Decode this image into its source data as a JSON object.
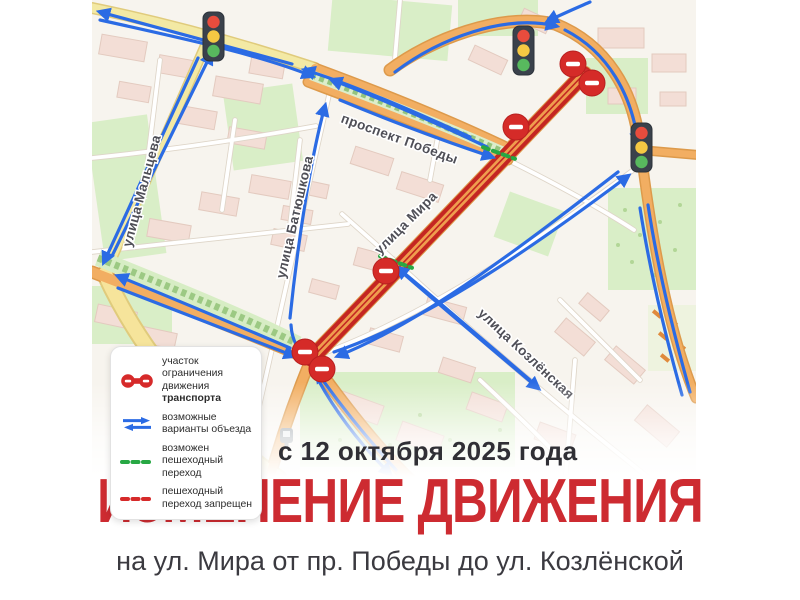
{
  "poster": {
    "date_banner": "с 12 октября 2025 года",
    "title": "ИЗМЕНЕНИЕ ДВИЖЕНИЯ",
    "subtitle": "на ул. Мира от пр. Победы до ул. Козлёнской",
    "title_color": "#cd2b31"
  },
  "legend": {
    "items": [
      {
        "icon": "restricted-segment-icon",
        "line1": "участок ограничения",
        "line2": "движения ",
        "line2_bold": "транспорта"
      },
      {
        "icon": "detour-arrows-icon",
        "line1": "возможные",
        "line2": "варианты объезда",
        "line2_bold": ""
      },
      {
        "icon": "crossing-allowed-icon",
        "line1": "возможен",
        "line2": "пешеходный переход",
        "line2_bold": ""
      },
      {
        "icon": "crossing-forbidden-icon",
        "line1": "пешеходный",
        "line2": "переход запрещен",
        "line2_bold": ""
      }
    ]
  },
  "map": {
    "street_labels": [
      {
        "text": "улица Мальцева",
        "x": 146,
        "y": 192,
        "rot": -75
      },
      {
        "text": "улица Батюшкова",
        "x": 299,
        "y": 218,
        "rot": -77
      },
      {
        "text": "проспект Победы",
        "x": 398,
        "y": 143,
        "rot": 20
      },
      {
        "text": "улица Мира",
        "x": 409,
        "y": 226,
        "rot": -45
      },
      {
        "text": "улица Козлёнская",
        "x": 523,
        "y": 357,
        "rot": 43
      }
    ],
    "traffic_lights": [
      {
        "x": 203,
        "y": 12
      },
      {
        "x": 513,
        "y": 26
      },
      {
        "x": 631,
        "y": 123
      }
    ],
    "no_entry_signs": [
      {
        "x": 573,
        "y": 64
      },
      {
        "x": 592,
        "y": 83
      },
      {
        "x": 516,
        "y": 127
      },
      {
        "x": 386,
        "y": 271
      },
      {
        "x": 305,
        "y": 352
      },
      {
        "x": 322,
        "y": 369
      }
    ],
    "crossings": [
      {
        "type": "allowed",
        "x": 499,
        "y": 153,
        "rot": 20,
        "len": 34
      },
      {
        "type": "allowed",
        "x": 396,
        "y": 262,
        "rot": 20,
        "len": 34
      },
      {
        "type": "forbidden",
        "x": 584,
        "y": 70,
        "rot": 22,
        "len": 40
      }
    ],
    "restricted_segment": {
      "d": "M 584 74 L 311 359"
    },
    "detour_arrows": [
      {
        "d": "M 470 137 C 400 105 345 82 305 70",
        "head": true
      },
      {
        "d": "M 292 64 C 210 42 150 26 100 12",
        "head": true
      },
      {
        "d": "M 100 20 C 200 42 262 56 312 76",
        "head": true
      },
      {
        "d": "M 395 72 C 440 38 505 14 556 26",
        "head": true
      },
      {
        "d": "M 565 30 C 608 52 632 95 638 143",
        "head": true
      },
      {
        "d": "M 590 2 C 574 9 560 15 548 21",
        "head": true
      },
      {
        "d": "M 198 58 L 104 262",
        "head": true
      },
      {
        "d": "M 112 256 L 211 54",
        "head": true
      },
      {
        "d": "M 290 318 C 297 250 310 160 325 106",
        "head": true
      },
      {
        "d": "M 291 325 C 292 342 299 351 307 357",
        "head": true
      },
      {
        "d": "M 340 100 C 400 125 450 143 492 157",
        "head": true
      },
      {
        "d": "M 487 147 C 432 121 382 99 332 80",
        "head": true
      },
      {
        "d": "M 396 470 C 365 436 338 402 317 372",
        "head": true
      },
      {
        "d": "M 312 368 C 330 404 356 440 390 474",
        "head": true
      },
      {
        "d": "M 334 352 C 430 320 540 242 628 176",
        "head": true
      },
      {
        "d": "M 618 172 C 530 240 424 322 338 356",
        "head": true
      },
      {
        "d": "M 404 274 C 455 318 500 356 538 388",
        "head": true
      },
      {
        "d": "M 530 380 C 490 346 444 306 398 268",
        "head": true
      },
      {
        "d": "M 118 288 C 190 316 252 340 294 356",
        "head": true
      },
      {
        "d": "M 290 348 C 220 318 162 294 118 276",
        "head": true
      },
      {
        "d": "M 648 205 C 658 270 674 335 690 392",
        "head": false
      },
      {
        "d": "M 640 208 C 650 272 666 338 682 395",
        "head": false
      }
    ],
    "icons": [
      {
        "name": "transit-stop-icon",
        "x": 280,
        "y": 428
      }
    ],
    "colors": {
      "arrow": "#2b6be4",
      "restricted_outer": "#c42622",
      "restricted_inner": "#ef9d4e",
      "crossing_allowed": "#27a844",
      "crossing_forbidden": "#d02d2d",
      "sign_red": "#d52b28",
      "label": "#4f4f57",
      "light_red": "#e84c3d",
      "light_yellow": "#f5c843",
      "light_green": "#58b95e"
    }
  }
}
